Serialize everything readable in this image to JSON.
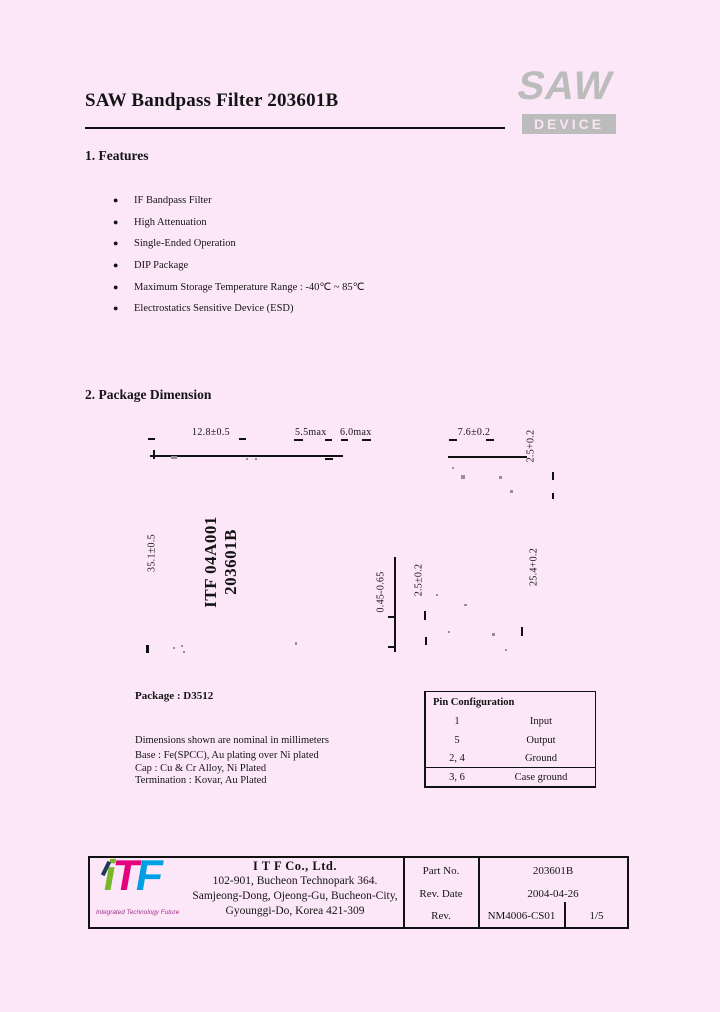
{
  "header": {
    "title": "SAW Bandpass Filter 203601B",
    "logo_text": "SAW",
    "logo_subtext": "DEVICE"
  },
  "colors": {
    "page_background": "#fce7f8",
    "logo_gray": "#bcbcbc",
    "itf_green": "#76b82a",
    "itf_magenta": "#e5007d",
    "itf_blue": "#009fe3"
  },
  "features": {
    "heading": "1. Features",
    "bullet": "●",
    "items": [
      "IF Bandpass Filter",
      "High Attenuation",
      "Single-Ended Operation",
      "DIP Package",
      "Maximum Storage Temperature Range : -40℃ ~ 85℃",
      "Electrostatics Sensitive Device (ESD)"
    ]
  },
  "dimension": {
    "heading": "2. Package Dimension",
    "labels": {
      "body_width": "12.8±0.5",
      "height_max1": "5.5max",
      "height_max2": "6.0max",
      "top_width": "7.6±0.2",
      "top_depth": "2.5+0.2",
      "body_height": "35.1±0.5",
      "lead_width": "0.45-0.65",
      "lead_pitch": "2.5±0.2",
      "lead_length": "25.4+0.2",
      "marking_line1": "ITF 04A001",
      "marking_line2": "203601B"
    },
    "package_name": "Package : D3512",
    "note_dimensions": "Dimensions shown are nominal in millimeters",
    "notes": [
      "Base : Fe(SPCC), Au plating over Ni plated",
      "Cap : Cu & Cr Alloy, Ni Plated",
      "Termination : Kovar, Au Plated"
    ]
  },
  "pin_config": {
    "title": "Pin Configuration",
    "rows": [
      {
        "pin": "1",
        "function": "Input"
      },
      {
        "pin": "5",
        "function": "Output"
      },
      {
        "pin": "2, 4",
        "function": "Ground"
      },
      {
        "pin": "3, 6",
        "function": "Case ground"
      }
    ]
  },
  "footer": {
    "logo": {
      "i": "i",
      "t": "T",
      "f": "F",
      "tagline": "Integrated Technology Future"
    },
    "company": "I T F   Co., Ltd.",
    "address": [
      "102-901, Bucheon Technopark 364.",
      "Samjeong-Dong, Ojeong-Gu, Bucheon-City,",
      "Gyounggi-Do, Korea 421-309"
    ],
    "table": {
      "part_no_label": "Part No.",
      "part_no": "203601B",
      "rev_date_label": "Rev. Date",
      "rev_date": "2004-04-26",
      "rev_label": "Rev.",
      "rev": "NM4006-CS01",
      "page": "1/5"
    }
  }
}
